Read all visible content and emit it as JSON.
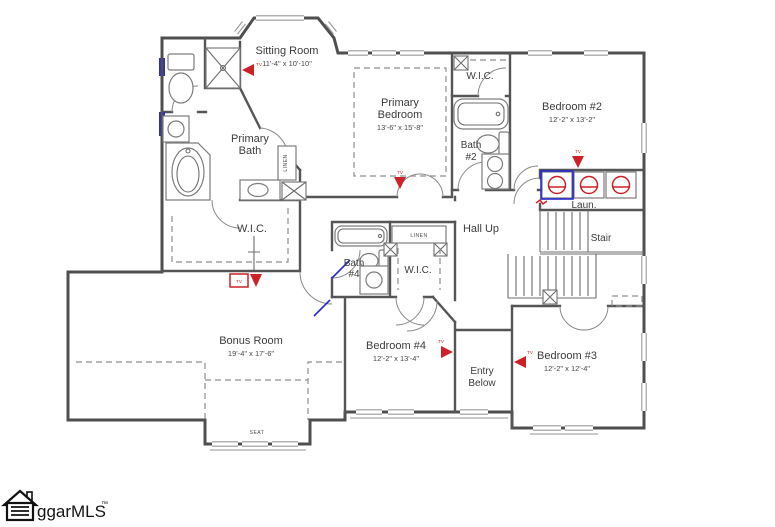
{
  "colors": {
    "wall": "#4f4f4f",
    "accent_red": "#cc2127",
    "accent_blue": "#2a2ad0",
    "dash_gray": "#8f8f8f",
    "text": "#3c3c3c"
  },
  "rooms": {
    "sitting_room": {
      "name": "Sitting Room",
      "dims": "11'-4\" x 10'-10\""
    },
    "primary_bedroom": {
      "name_line1": "Primary",
      "name_line2": "Bedroom",
      "dims": "13'-6\" x 15'-8\""
    },
    "primary_bath": {
      "name_line1": "Primary",
      "name_line2": "Bath"
    },
    "wic_primary": {
      "name": "W.I.C."
    },
    "wic_upper": {
      "name": "W.I.C."
    },
    "wic_bed4": {
      "name": "W.I.C."
    },
    "bath_2": {
      "name_line1": "Bath",
      "name_line2": "#2"
    },
    "bath_4": {
      "name_line1": "Bath",
      "name_line2": "#4"
    },
    "bedroom_2": {
      "name": "Bedroom #2",
      "dims": "12'-2\" x 13'-2\""
    },
    "bedroom_3": {
      "name": "Bedroom #3",
      "dims": "12'-2\" x 12'-4\""
    },
    "bedroom_4": {
      "name": "Bedroom #4",
      "dims": "12'-2\" x 13'-4\""
    },
    "bonus_room": {
      "name": "Bonus Room",
      "dims": "19'-4\" x 17'-6\""
    },
    "laundry": {
      "name": "Laun."
    },
    "stair": {
      "name": "Stair"
    },
    "hall": {
      "name": "Hall Up"
    },
    "entry": {
      "name_line1": "Entry",
      "name_line2": "Below"
    }
  },
  "annotations": {
    "linen": "LINEN",
    "seat": "SEAT",
    "tv": "TV"
  },
  "logo": {
    "brand": "ggarMLS",
    "trademark": "™"
  }
}
